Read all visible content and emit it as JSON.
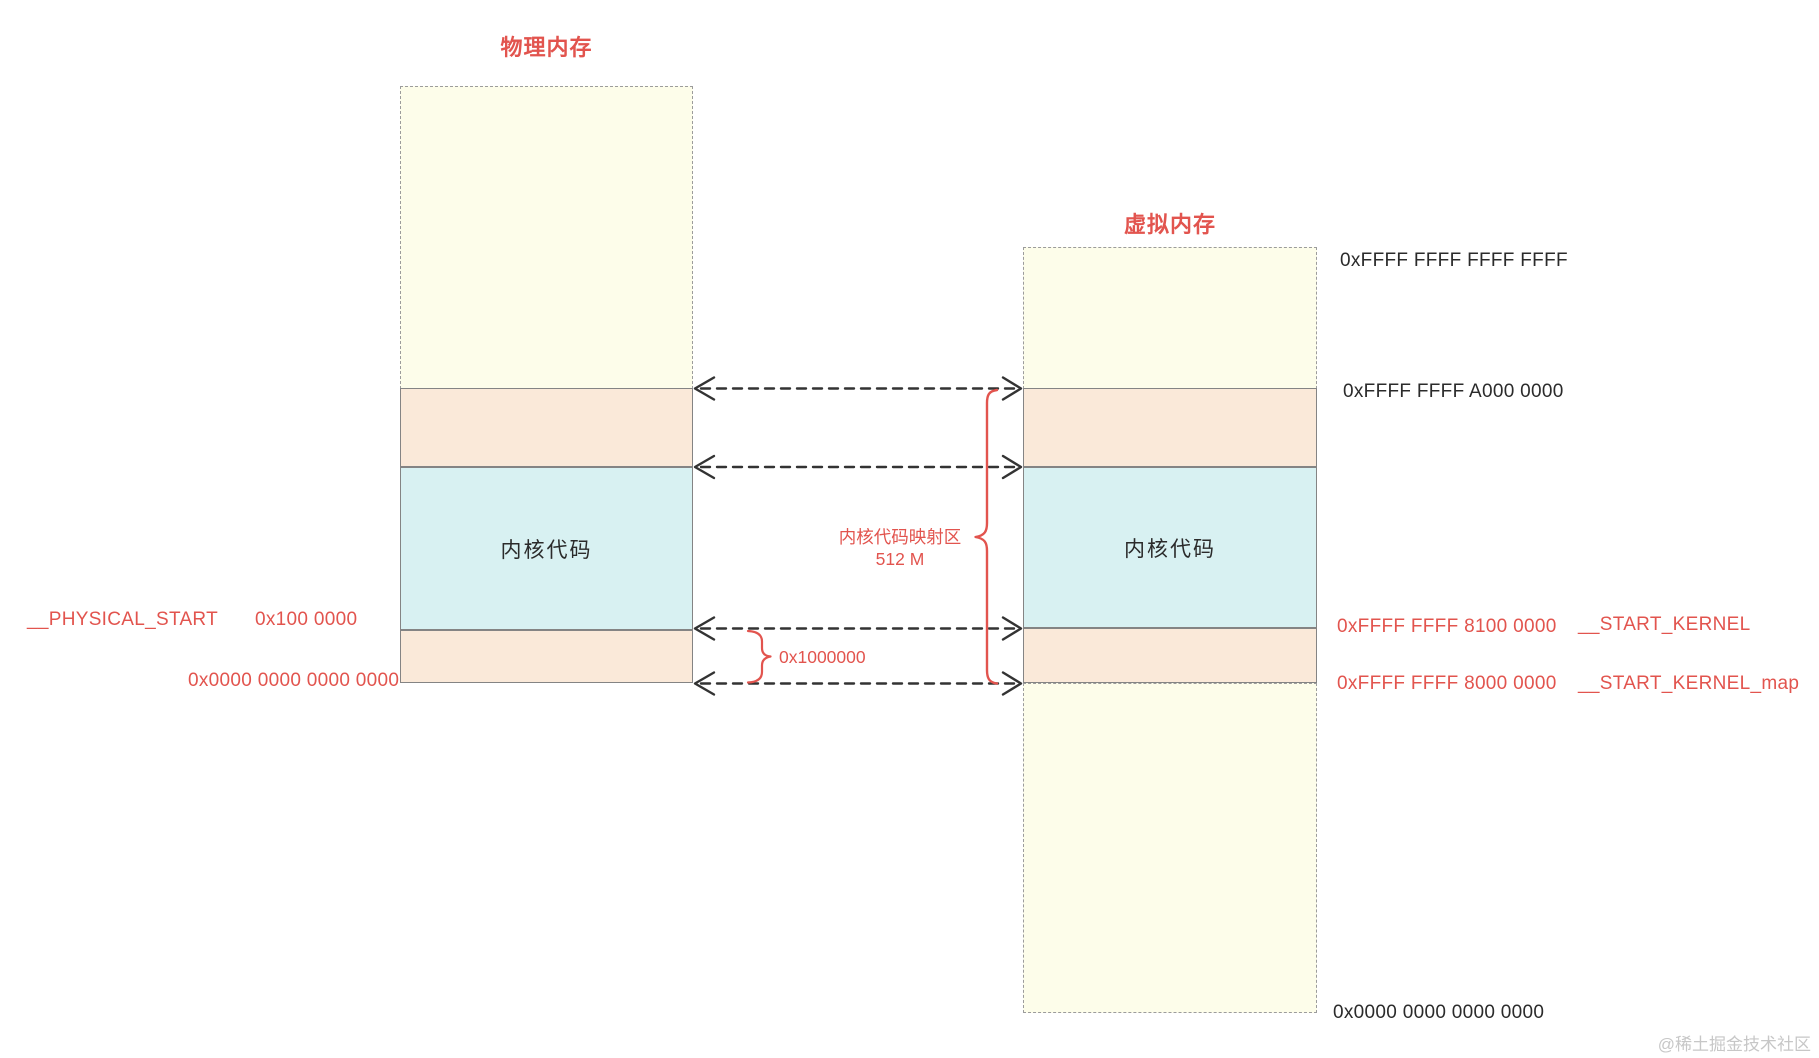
{
  "colors": {
    "red": "#e2544e",
    "cream": "#fdfdea",
    "peach": "#fae9d9",
    "blue": "#d8f1f2"
  },
  "physical": {
    "title": "物理内存",
    "kernel_region_label": "内核代码",
    "symbol_label": "__PHYSICAL_START",
    "start_address": "0x100 0000",
    "base_address": "0x0000 0000 0000 0000"
  },
  "virtual": {
    "title": "虚拟内存",
    "kernel_region_label": "内核代码",
    "address_top": "0xFFFF FFFF FFFF FFFF",
    "address_a000": "0xFFFF FFFF A000 0000",
    "address_8100": "0xFFFF FFFF 8100 0000",
    "address_8000": "0xFFFF FFFF 8000 0000",
    "address_bottom": "0x0000 0000 0000 0000",
    "symbol_start_kernel": "__START_KERNEL",
    "symbol_start_kernel_map": "__START_KERNEL_map"
  },
  "annotations": {
    "map_region_name": "内核代码映射区",
    "map_region_size": "512 M",
    "offset_label": "0x1000000"
  },
  "watermark": "@稀土掘金技术社区"
}
